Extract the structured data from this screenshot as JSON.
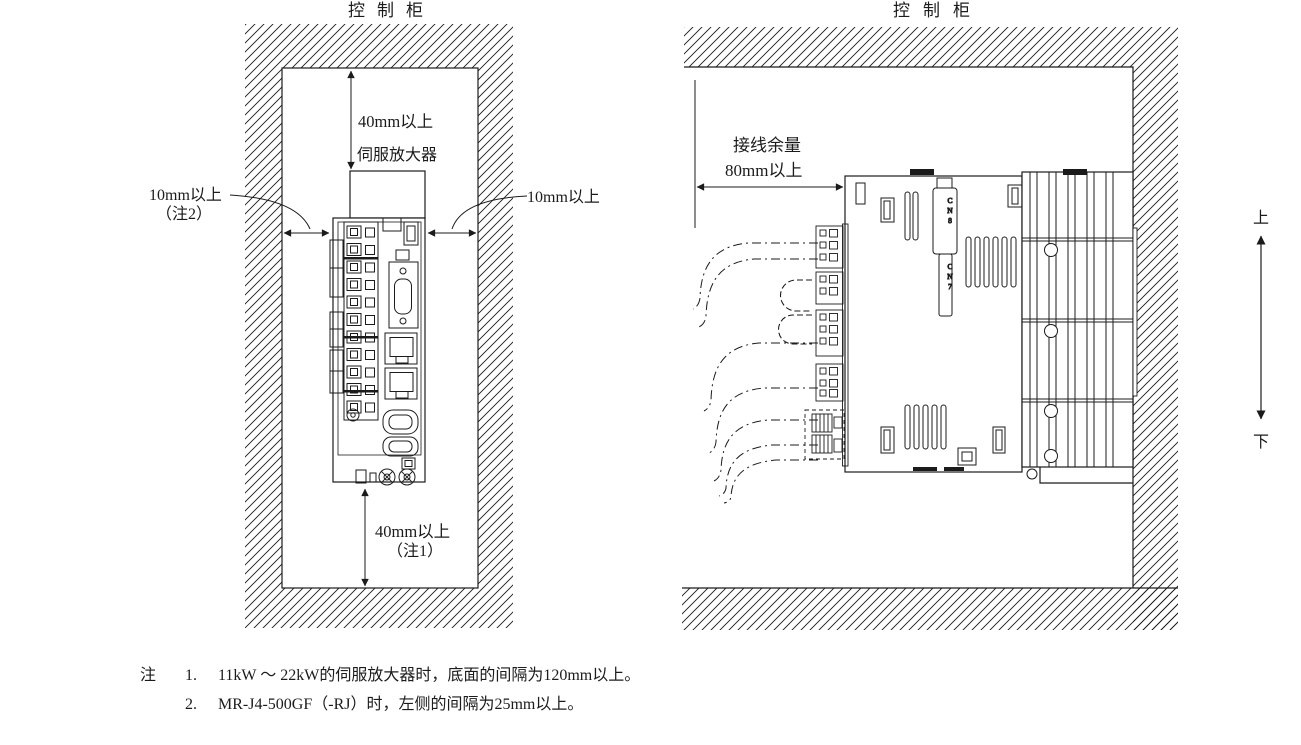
{
  "figure": {
    "left_diagram": {
      "title": "控制柜",
      "device_label": "伺服放大器",
      "dim_top": "40mm以上",
      "dim_bottom_line1": "40mm以上",
      "dim_bottom_line2": "（注1）",
      "dim_left_line1": "10mm以上",
      "dim_left_line2": "（注2）",
      "dim_right": "10mm以上"
    },
    "right_diagram": {
      "title": "控制柜",
      "wiring_allowance_line1": "接线余量",
      "wiring_allowance_line2": "80mm以上",
      "up_label": "上",
      "down_label": "下",
      "connector_label_cn8": "CN8",
      "connector_label_cn7": "CN7"
    },
    "notes": {
      "prefix": "注",
      "items": [
        {
          "num": "1.",
          "text": "11kW ～ 22kW的伺服放大器时，底面的间隔为120mm以上。"
        },
        {
          "num": "2.",
          "text": "MR-J4-500GF（-RJ）时，左侧的间隔为25mm以上。"
        }
      ]
    },
    "colors": {
      "line": "#1b1b1b",
      "background": "#ffffff"
    }
  }
}
